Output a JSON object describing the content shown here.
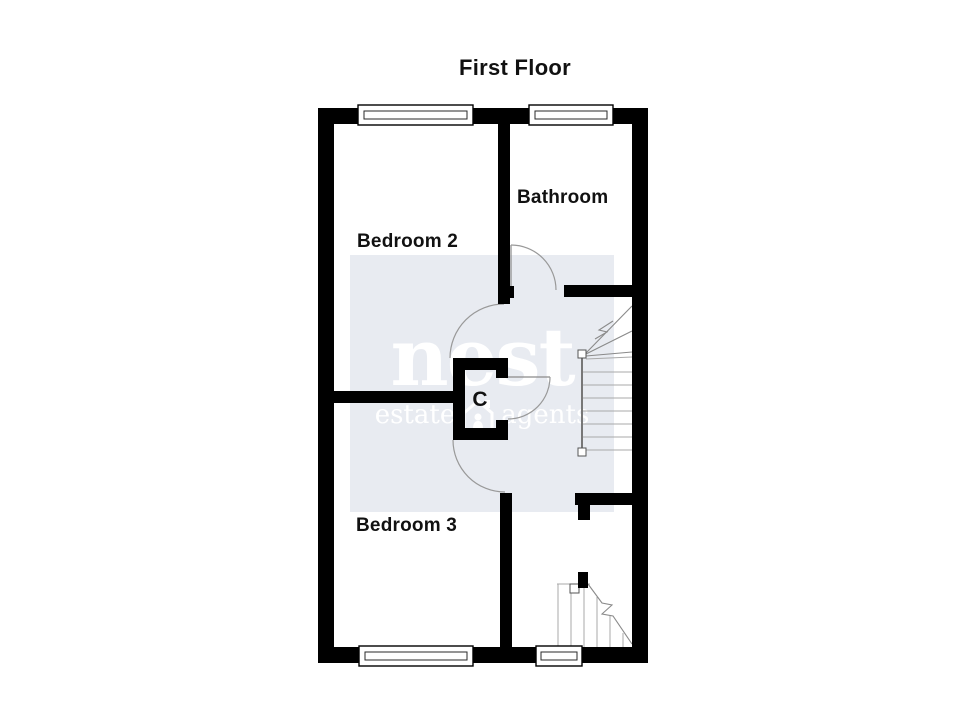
{
  "title": "First Floor",
  "rooms": {
    "bedroom2": {
      "label": "Bedroom 2"
    },
    "bathroom": {
      "label": "Bathroom"
    },
    "bedroom3": {
      "label": "Bedroom 3"
    },
    "cupboard": {
      "label": "C"
    }
  },
  "watermark": {
    "brand": "nest",
    "tagline_left": "estate",
    "tagline_right": "agents"
  },
  "features": {
    "doors": [
      "bathroom-door",
      "bedroom2-door",
      "cupboard-door",
      "bedroom3-door"
    ],
    "stairs": [
      "upper-flight-up-arrow",
      "lower-flight-cut"
    ],
    "window_count": 4
  },
  "colors": {
    "wall": "#000000",
    "background": "#ffffff",
    "watermark_bg": "#e8ebf1",
    "watermark_text": "#ffffff",
    "line": "#999999",
    "label_text": "#111111"
  }
}
